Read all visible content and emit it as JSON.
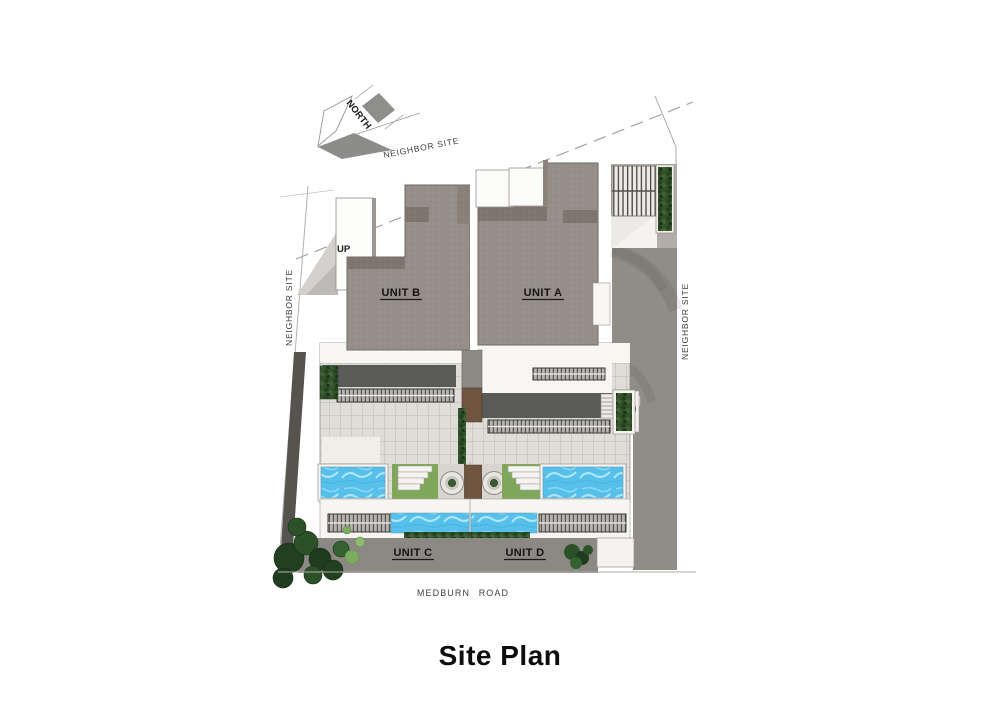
{
  "page_title": "Site Plan",
  "drawing": {
    "north_label": "NORTH",
    "up_label": "UP",
    "boundary_top_label": "NEIGHBOR SITE",
    "boundary_left_label": "NEIGHBOR SITE",
    "boundary_right_label": "NEIGHBOR SITE",
    "road_label": "MEDBURN ROAD",
    "units": {
      "a": "UNIT A",
      "b": "UNIT B",
      "c": "UNIT C",
      "d": "UNIT D"
    },
    "colors": {
      "roof": "#968e88",
      "roof_shadow": "#7e756e",
      "paving_light": "#dfddd7",
      "paving_white": "#f7f6f3",
      "deck_dark": "#5a5a59",
      "driveway": "#908c88",
      "apron": "#8c8985",
      "pool": "#57c0ea",
      "lawn": "#7ea75a",
      "hedge": "#33512b",
      "planter_brown": "#6f5440",
      "fence_dark": "#57544f"
    }
  }
}
